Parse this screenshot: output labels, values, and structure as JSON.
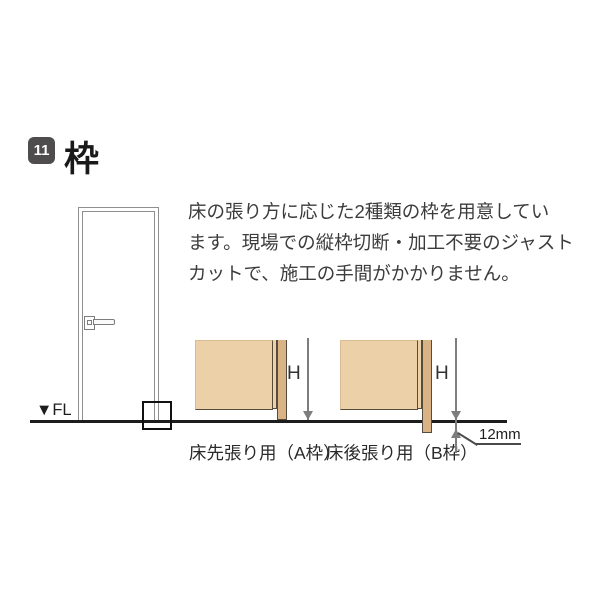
{
  "header": {
    "badge_number": "11",
    "title": "枠"
  },
  "intro": {
    "lines": [
      "床の張り方に応じた2種類の枠を用意してい",
      "ます。現場での縦枠切断・加工不要のジャスト",
      "カットで、施工の手間がかかりません。"
    ]
  },
  "door_diagram": {
    "floor_level_label": "▼FL"
  },
  "frame_diagrams": {
    "a": {
      "label": "床先張り用（A枠）",
      "height_label": "H"
    },
    "b": {
      "label": "床後張り用（B枠）",
      "height_label": "H",
      "offset_label": "12mm"
    }
  },
  "colors": {
    "page_bg": "#ffffff",
    "badge_bg": "#4e4c4c",
    "text": "#3c3c3c",
    "wall_fill": "#ecd0a7",
    "frame_fill": "#d9b285",
    "wood_edge": "#564c3c",
    "floor_line": "#1c1c1c",
    "dim_line": "#7d7d7d"
  }
}
